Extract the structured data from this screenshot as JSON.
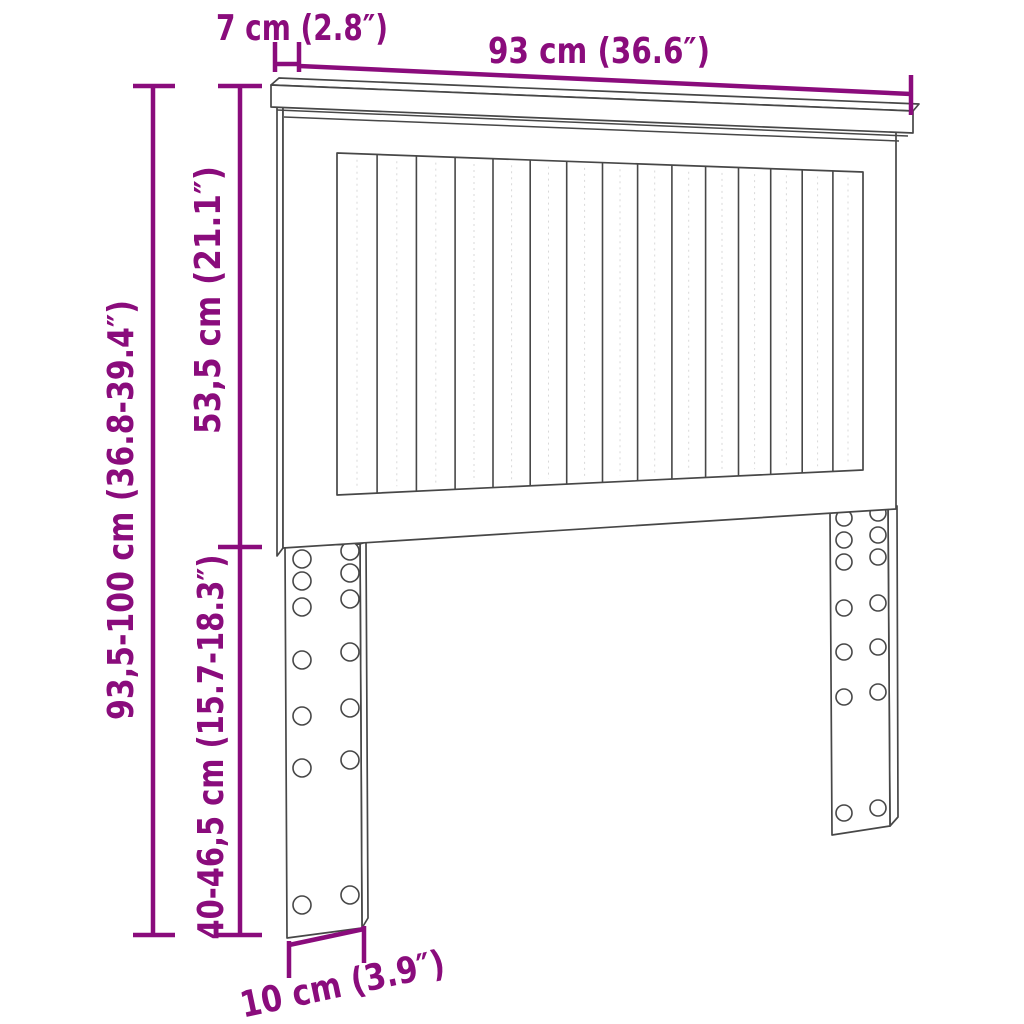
{
  "colors": {
    "accent": "#8A0C7C",
    "line": "#474747",
    "background": "#FFFFFF"
  },
  "labels": {
    "shelf_depth": "7 cm (2.8″)",
    "width": "93 cm (36.6″)",
    "total_height": "93,5-100 cm (36.8-39.4″)",
    "panel_height": "53,5 cm (21.1″)",
    "leg_height": "40-46,5 cm (15.7-18.3″)",
    "leg_width": "10 cm (3.9″)"
  },
  "structure": {
    "slat_count": 15,
    "legs": {
      "count": 2,
      "hole_columns": 2,
      "hole_rows": 7
    }
  }
}
